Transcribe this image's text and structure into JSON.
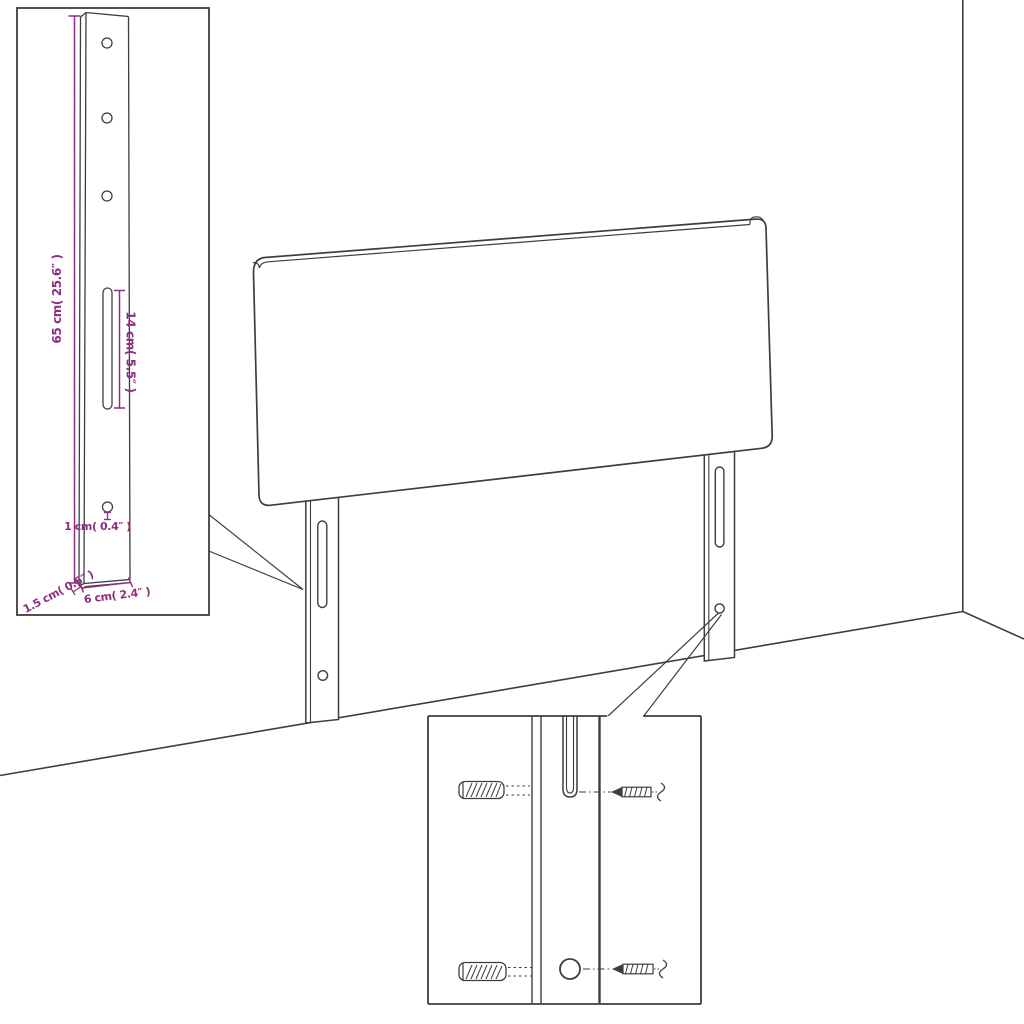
{
  "colors": {
    "line": "#3e3e3e",
    "dimension": "#8b2f7e",
    "background": "#ffffff"
  },
  "insets": {
    "bracket": {
      "name": "leg-bracket-detail",
      "dims": {
        "height": "65 cm( 25.6″ )",
        "slot_length": "14 cm( 5.5″ )",
        "hole": "1 cm( 0.4″ )",
        "thickness": "1.5 cm( 0.6″ )",
        "width": "6 cm( 2.4″ )"
      }
    },
    "hardware": {
      "name": "wall-mounting-hardware-detail",
      "icons": [
        "wall-plug-icon",
        "screw-icon"
      ]
    }
  }
}
